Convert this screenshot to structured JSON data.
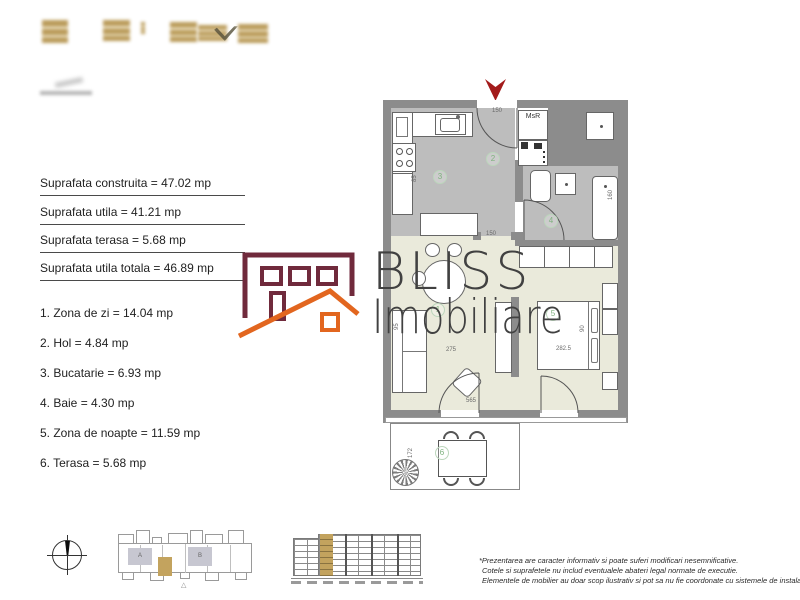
{
  "left_panel": {
    "measurements": [
      "Suprafata construita = 47.02 mp",
      "Suprafata utila = 41.21 mp",
      "Suprafata terasa = 5.68 mp",
      "Suprafata utila totala = 46.89 mp"
    ],
    "room_list": [
      "1. Zona de zi = 14.04 mp",
      "2. Hol = 4.84 mp",
      "3. Bucatarie = 6.93 mp",
      "4. Baie = 4.30 mp",
      "5. Zona de noapte = 11.59 mp",
      "6. Terasa = 5.68 mp"
    ]
  },
  "watermark": {
    "brand_line1": "BLISS",
    "brand_line2": "Imobiliare"
  },
  "floorplan": {
    "closet_label": "MsR",
    "room_numbers": [
      "1",
      "2",
      "3",
      "4",
      "5",
      "6"
    ],
    "dimensions": {
      "entrance_width": "150",
      "hall_opening": "150",
      "living_width": "275",
      "bedroom_width": "282.5",
      "bottom_width": "565",
      "terrace_depth": "172",
      "bed_side": "90",
      "sofa_depth": "95",
      "kitchen_dim": "85",
      "bath_dim": "160"
    }
  },
  "site_plan": {
    "section_a_label": "A",
    "section_b_label": "B",
    "marker": "△"
  },
  "disclaimer": {
    "line1": "*Prezentarea are caracter informativ si poate suferi modificari nesemnificative.",
    "line2": "Cotele si suprafetele nu includ eventualele abateri legal normate de executie.",
    "line3": "Elementele de mobilier au doar scop ilustrativ si pot sa nu fie coordonate cu sistemele de instalatii"
  },
  "colors": {
    "wall": "#8c8c8c",
    "floor_gray": "#bdbdbd",
    "floor_cream": "#eaeadb",
    "accent_tan": "#c3a35e",
    "brand_maroon": "#702a3c",
    "brand_orange": "#e2661f",
    "label_green": "#7fb27f",
    "arrow_red": "#a31b1b"
  }
}
